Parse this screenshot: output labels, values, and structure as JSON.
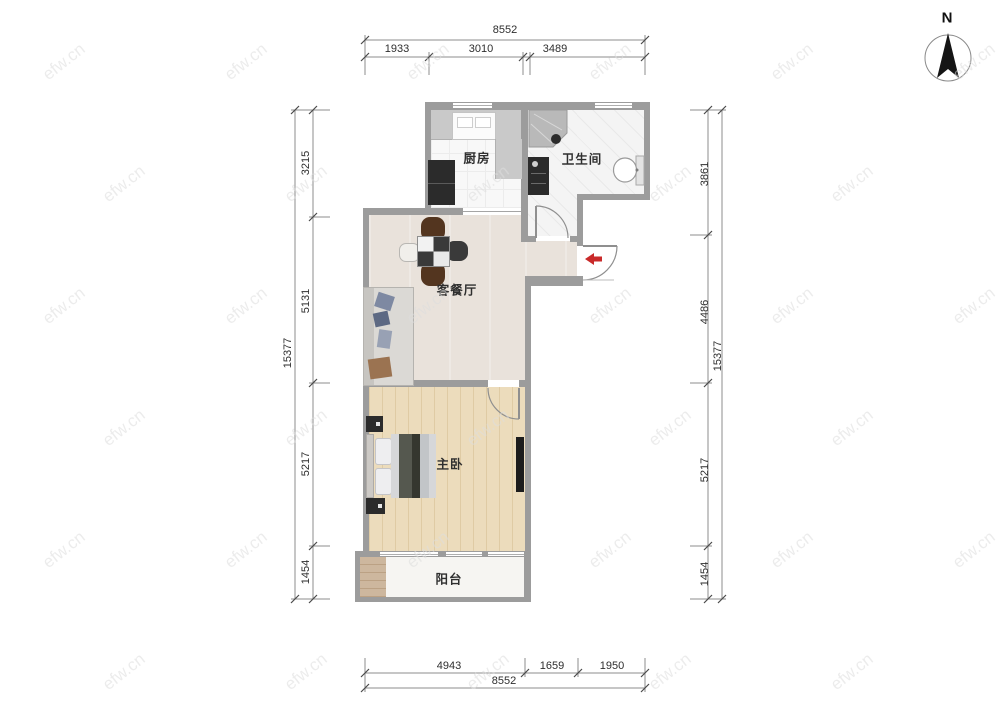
{
  "watermark": {
    "text": "efw.cn"
  },
  "compass": {
    "label": "N"
  },
  "rooms": {
    "kitchen": {
      "label": "厨房"
    },
    "bathroom": {
      "label": "卫生间"
    },
    "living_dining": {
      "label": "客餐厅"
    },
    "master_bedroom": {
      "label": "主卧"
    },
    "balcony": {
      "label": "阳台"
    }
  },
  "dimensions": {
    "top": {
      "total": "8552",
      "seg1": "1933",
      "seg2": "3010",
      "seg3": "3489"
    },
    "bottom": {
      "total": "8552",
      "seg1": "4943",
      "seg2": "1659",
      "seg3": "1950"
    },
    "left": {
      "total": "15377",
      "seg1": "3215",
      "seg2": "5131",
      "seg3": "5217",
      "seg4": "1454"
    },
    "right": {
      "total": "15377",
      "seg1": "3861",
      "seg2": "4486",
      "seg3": "5217",
      "seg4": "1454"
    }
  },
  "colors": {
    "wall": "#9c9c9c",
    "kitchen_floor": "#f8f8f8",
    "bath_floor": "#f4f4f4",
    "living_floor": "#e9e2db",
    "bedroom_floor": "#ecdcbc",
    "balcony_floor": "#f6f5f2",
    "balcony_wood": "#cdb79e",
    "counter": "#c9c9c9",
    "entrance_arrow": "#c92a2a",
    "furniture_dark": "#2b2b2b",
    "dining_chair_brown": "#53351f",
    "dim_text": "#2e2e2e",
    "watermark": "#dedede"
  }
}
